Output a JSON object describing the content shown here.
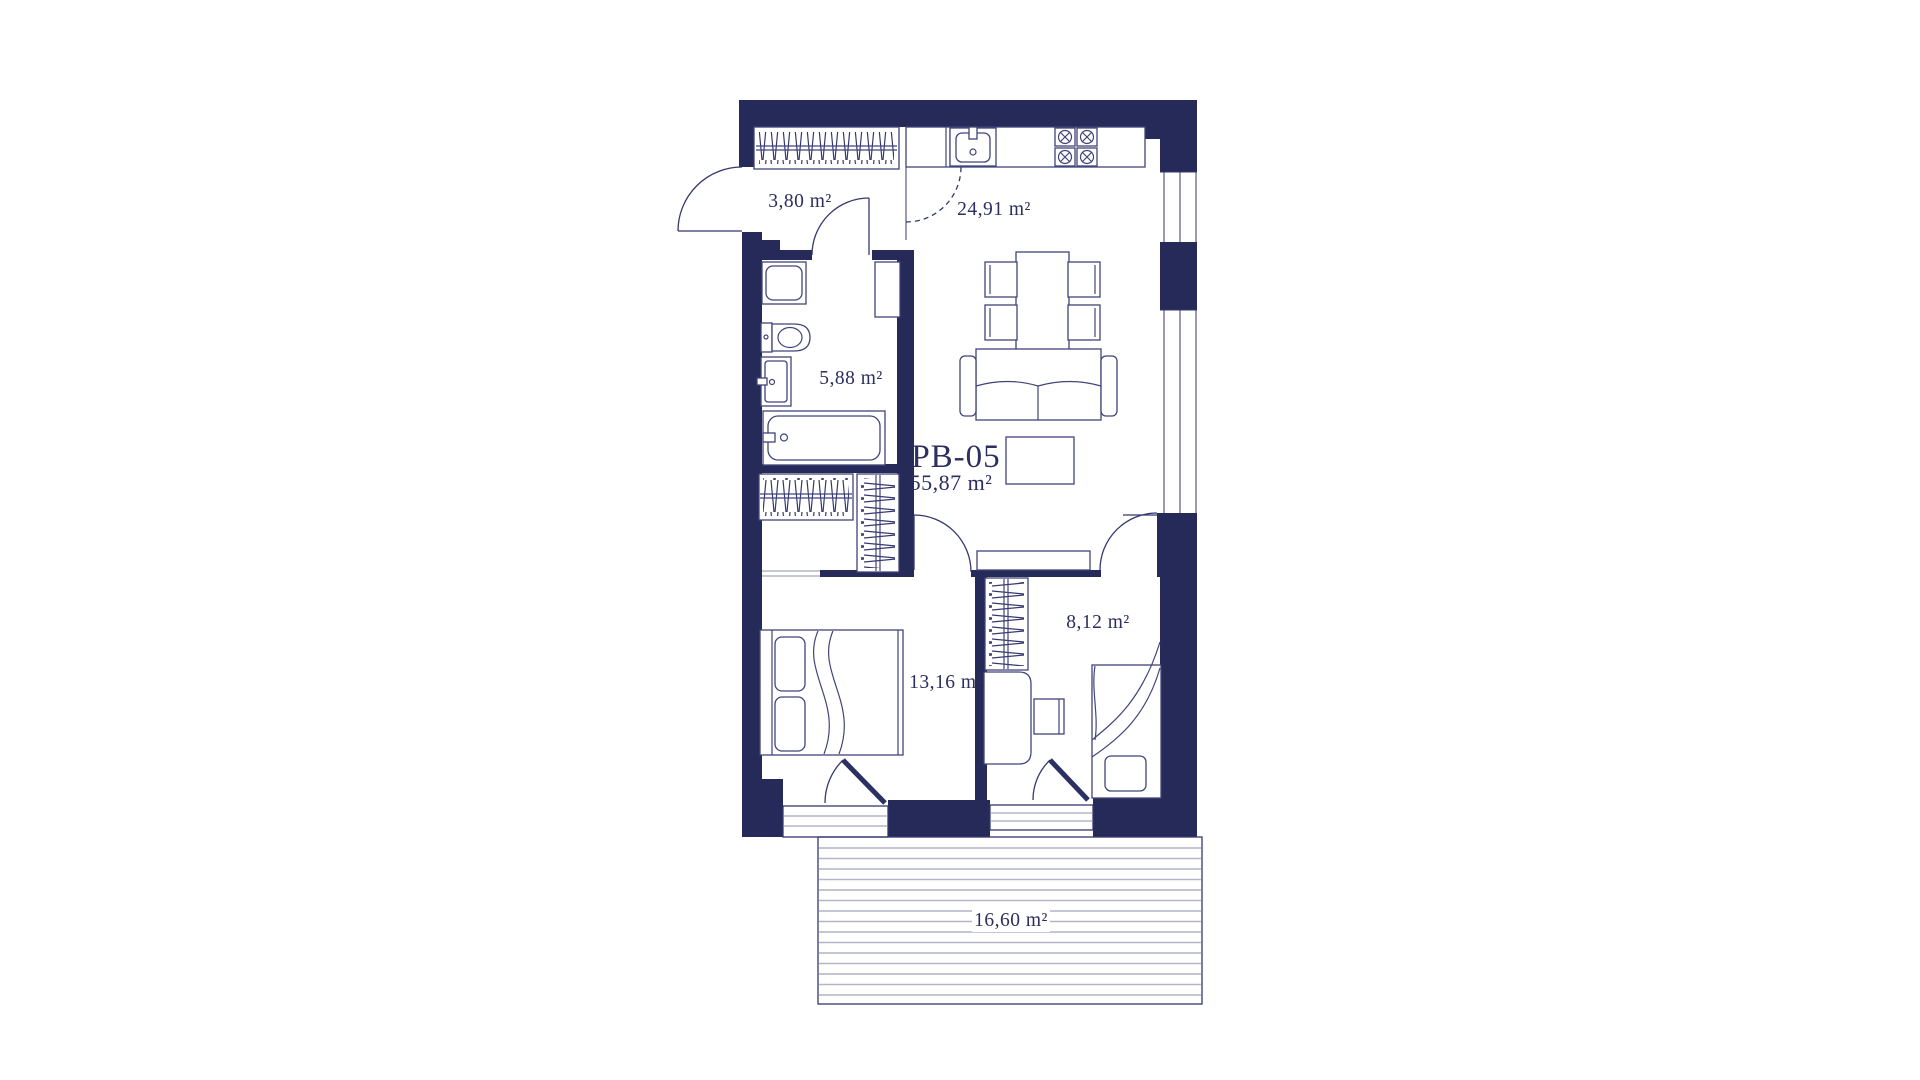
{
  "plan": {
    "unit": {
      "code": "PB-05",
      "total_area": "55,87 m²"
    },
    "rooms": {
      "hallway": "3,80 m²",
      "kitchen_living": "24,91 m²",
      "bathroom": "5,88 m²",
      "bedroom_main": "13,16 m²",
      "bedroom_second": "8,12 m²",
      "terrace": "16,60 m²"
    },
    "colors": {
      "wall": "#262a59",
      "line": "#35386e",
      "furniture_line": "#41447a",
      "light_line": "#8d90b0",
      "terrace_plank": "#b2b4c7",
      "text": "#2b2e5e",
      "background": "#ffffff"
    }
  }
}
